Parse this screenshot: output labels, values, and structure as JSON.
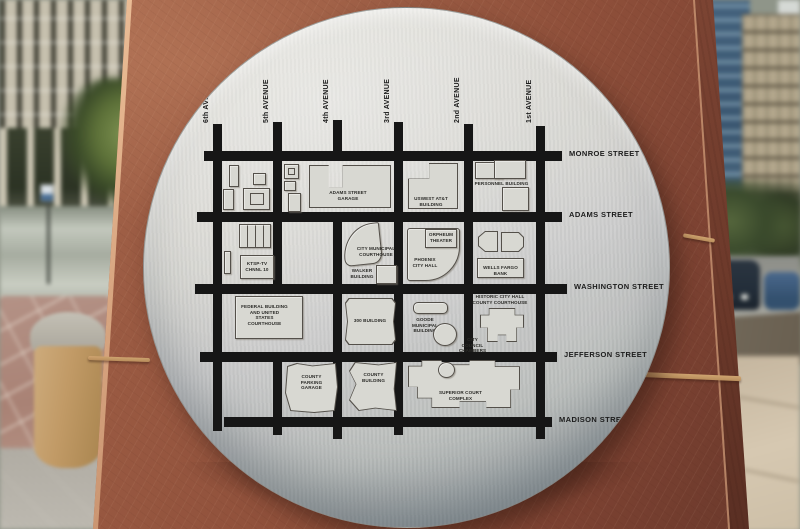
{
  "plaque": {
    "streets": [
      {
        "name": "MONROE STREET",
        "y": 150,
        "x1": 203,
        "x2": 561
      },
      {
        "name": "ADAMS STREET",
        "y": 211,
        "x1": 196,
        "x2": 561
      },
      {
        "name": "WASHINGTON STREET",
        "y": 283,
        "x1": 194,
        "x2": 566
      },
      {
        "name": "JEFFERSON STREET",
        "y": 351,
        "x1": 199,
        "x2": 556
      },
      {
        "name": "MADISON STREET",
        "y": 416,
        "x1": 223,
        "x2": 551
      }
    ],
    "avenues": [
      {
        "name": "6th AVENUE",
        "x": 212,
        "segments": [
          [
            123,
            430
          ]
        ]
      },
      {
        "name": "5th AVENUE",
        "x": 272,
        "segments": [
          [
            121,
            283
          ],
          [
            351,
            434
          ]
        ]
      },
      {
        "name": "4th AVENUE",
        "x": 332,
        "segments": [
          [
            119,
            155
          ],
          [
            211,
            438
          ]
        ]
      },
      {
        "name": "3rd AVENUE",
        "x": 393,
        "segments": [
          [
            121,
            434
          ]
        ]
      },
      {
        "name": "2nd AVENUE",
        "x": 463,
        "segments": [
          [
            123,
            355
          ]
        ]
      },
      {
        "name": "1st AVENUE",
        "x": 535,
        "segments": [
          [
            125,
            438
          ]
        ]
      }
    ],
    "buildings": [
      {
        "name": "",
        "x": 228,
        "y": 164,
        "w": 10,
        "h": 22
      },
      {
        "name": "",
        "x": 252,
        "y": 172,
        "w": 13,
        "h": 12
      },
      {
        "name": "",
        "x": 222,
        "y": 188,
        "w": 11,
        "h": 21
      },
      {
        "name": "",
        "x": 242,
        "y": 187,
        "w": 27,
        "h": 22,
        "shape": "inner"
      },
      {
        "name": "",
        "x": 283,
        "y": 163,
        "w": 15,
        "h": 15,
        "shape": "inner"
      },
      {
        "name": "",
        "x": 283,
        "y": 180,
        "w": 12,
        "h": 10
      },
      {
        "name": "",
        "x": 287,
        "y": 192,
        "w": 13,
        "h": 19
      },
      {
        "name": "ADAMS STREET GARAGE",
        "x": 308,
        "y": 164,
        "w": 82,
        "h": 43,
        "shape": "garage",
        "lx": 321,
        "ly": 189,
        "lw": 52
      },
      {
        "name": "USWEST AT&T BUILDING",
        "x": 407,
        "y": 162,
        "w": 50,
        "h": 46,
        "shape": "notch-tl",
        "lx": 409,
        "ly": 195,
        "lw": 42
      },
      {
        "name": "PERSONNEL BUILDING",
        "x": 474,
        "y": 161,
        "w": 28,
        "h": 17,
        "lx": 473,
        "ly": 180,
        "lw": 55
      },
      {
        "name": "",
        "x": 493,
        "y": 159,
        "w": 32,
        "h": 19
      },
      {
        "name": "",
        "x": 501,
        "y": 186,
        "w": 27,
        "h": 24
      },
      {
        "name": "",
        "x": 238,
        "y": 223,
        "w": 32,
        "h": 24,
        "shape": "stalls"
      },
      {
        "name": "",
        "x": 223,
        "y": 250,
        "w": 7,
        "h": 23
      },
      {
        "name": "KTSP-TV CHNNL 10",
        "x": 239,
        "y": 254,
        "w": 34,
        "h": 24,
        "lx": 241,
        "ly": 260,
        "lw": 30
      },
      {
        "name": "CITY MUNICIPAL COURTHOUSE",
        "x": 342,
        "y": 223,
        "w": 38,
        "h": 41,
        "shape": "fan",
        "lx": 355,
        "ly": 245,
        "lw": 40
      },
      {
        "name": "WALKER BUILDING",
        "x": 375,
        "y": 264,
        "w": 21,
        "h": 19,
        "lx": 348,
        "ly": 267,
        "lw": 26
      },
      {
        "name": "PHOENIX CITY HALL",
        "x": 406,
        "y": 227,
        "w": 53,
        "h": 53,
        "shape": "cityhall",
        "lx": 408,
        "ly": 256,
        "lw": 32
      },
      {
        "name": "ORPHEUM THEATER",
        "x": 424,
        "y": 228,
        "w": 32,
        "h": 19,
        "lx": 426,
        "ly": 231,
        "lw": 28
      },
      {
        "name": "",
        "x": 477,
        "y": 230,
        "w": 20,
        "h": 21,
        "shape": "d-left"
      },
      {
        "name": "",
        "x": 500,
        "y": 231,
        "w": 23,
        "h": 20,
        "shape": "d-right"
      },
      {
        "name": "WELLS FARGO BANK",
        "x": 476,
        "y": 257,
        "w": 47,
        "h": 20,
        "lx": 478,
        "ly": 264,
        "lw": 43
      },
      {
        "name": "FEDERAL BUILDING AND UNITED STATES COURTHOUSE",
        "x": 234,
        "y": 295,
        "w": 68,
        "h": 43,
        "lx": 240,
        "ly": 303,
        "lw": 47
      },
      {
        "name": "300 BUILDING",
        "x": 344,
        "y": 297,
        "w": 51,
        "h": 47,
        "shape": "chamfer",
        "lx": 349,
        "ly": 317,
        "lw": 40
      },
      {
        "name": "GOODE MUNICIPAL BUILDING",
        "x": 412,
        "y": 301,
        "w": 35,
        "h": 12,
        "shape": "pill",
        "lx": 403,
        "ly": 316,
        "lw": 42
      },
      {
        "name": "CITY COUNCIL CHAMBERS",
        "x": 432,
        "y": 322,
        "w": 24,
        "h": 23,
        "shape": "circle",
        "lx": 455,
        "ly": 336,
        "lw": 33
      },
      {
        "name": "HISTORIC CITY HALL COUNTY COURTHOUSE",
        "x": 479,
        "y": 307,
        "w": 44,
        "h": 34,
        "shape": "cross",
        "lx": 470,
        "ly": 293,
        "lw": 58
      },
      {
        "name": "COUNTY PARKING GARAGE",
        "x": 284,
        "y": 362,
        "w": 53,
        "h": 50,
        "shape": "jagged",
        "lx": 294,
        "ly": 373,
        "lw": 33
      },
      {
        "name": "COUNTY BUILDING",
        "x": 348,
        "y": 361,
        "w": 48,
        "h": 49,
        "shape": "county",
        "lx": 357,
        "ly": 371,
        "lw": 31
      },
      {
        "name": "SUPERIOR COURT COMPLEX",
        "x": 407,
        "y": 359,
        "w": 112,
        "h": 48,
        "shape": "complex",
        "lx": 427,
        "ly": 389,
        "lw": 65
      },
      {
        "name": "",
        "x": 437,
        "y": 361,
        "w": 17,
        "h": 16,
        "shape": "circle"
      }
    ]
  },
  "colors": {
    "plaque_metal_light": "#e2e1db",
    "plaque_metal_dark": "#8e979b",
    "street_ink": "#161616",
    "building_fill": "#d8d8d2",
    "building_outline": "#54504a",
    "pillar_sandstone_light": "#ad6f53",
    "pillar_sandstone_dark": "#67372a",
    "mortar_seam": "#c9a06b"
  }
}
